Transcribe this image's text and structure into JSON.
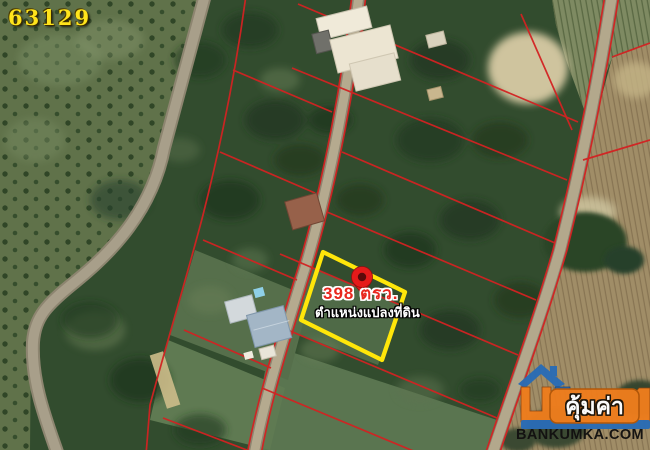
{
  "plot_number": "63129",
  "highlight": {
    "area_label": "398 ตรว.",
    "caption": "ตำแหน่งแปลงที่ดิน"
  },
  "watermark": {
    "banner_text": "คุ้มค่า",
    "website": "BANKUMKA.COM"
  },
  "icons": {
    "pin": "location-pin-icon",
    "logo": "house-logo-icon"
  },
  "colors": {
    "parcel_line_red": "#d32222",
    "highlight_outline_yellow": "#ffe60a",
    "pin_red": "#e51a1a",
    "area_text_red": "#e8281e",
    "plot_number_yellow": "#ffe41c",
    "logo_orange": "#ee7d1d",
    "logo_blue": "#2a6cb5",
    "road_tan": "#b5aa8f"
  }
}
